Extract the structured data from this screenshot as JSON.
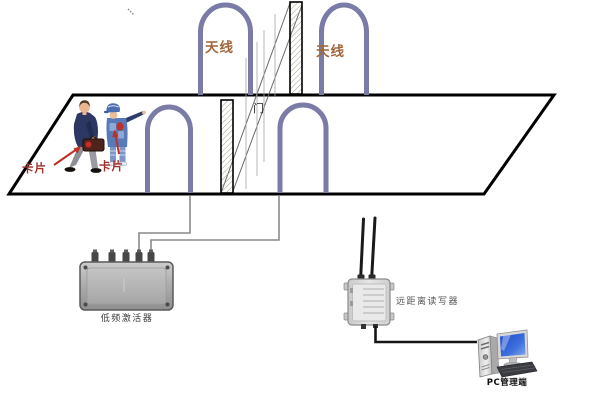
{
  "labels": {
    "antenna_top_left": "天线",
    "antenna_top_right": "天线",
    "door": "门",
    "card_person_left": "卡片",
    "card_person_right": "卡片",
    "activator": "低频激活器",
    "reader": "远距离读写器",
    "pc": "PC管理端"
  },
  "colors": {
    "arch": "#7b7ba8",
    "antenna_label": "#a0653a",
    "card_label": "#a03028",
    "arrow": "#c03026",
    "wire": "#8a8a8a",
    "cable": "#151515",
    "outline": "#000000",
    "hatch": "#9aa084",
    "device_body": "#b2b2b2",
    "reader_body": "#d6d6d6",
    "screen": "#2a56cf"
  },
  "components": {
    "overhead_antenna_count": 2,
    "floor_antenna_count": 2,
    "door_post_count": 2,
    "person_count": 2
  }
}
